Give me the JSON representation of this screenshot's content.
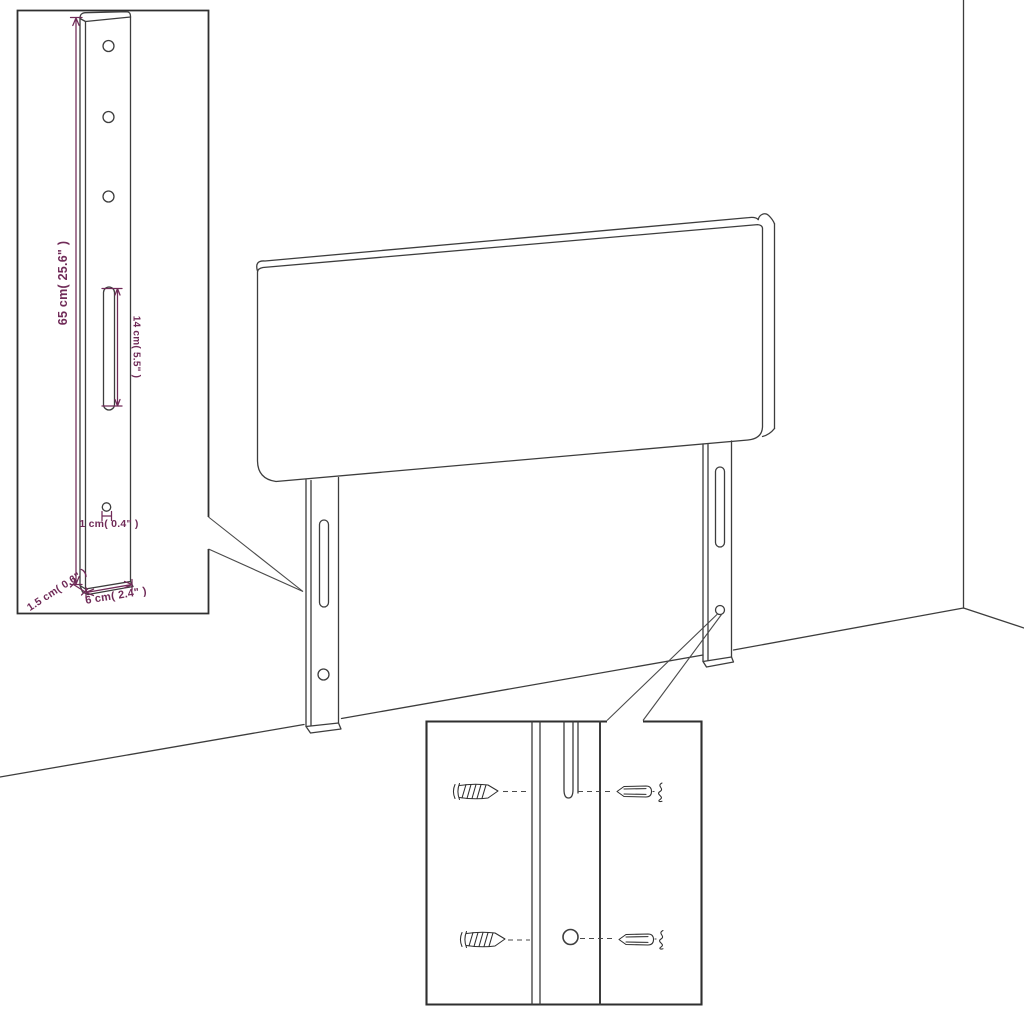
{
  "figure": {
    "kind": "furniture-assembly-dimension-diagram",
    "subject": "headboard with two mounting legs shown against a wall corner, with a bracket dimension callout and a screw mounting callout",
    "background": "#ffffff"
  },
  "colors": {
    "line_ink": "#3d3d3d",
    "dimension_ink": "#702b58"
  },
  "callouts": {
    "bracket_detail": {
      "labels": {
        "height": "65 cm( 25.6\" )",
        "slot_length": "14 cm( 5.5\" )",
        "hole": "1 cm( 0.4\" )",
        "thickness": "1.5 cm( 0.6\" )",
        "width": "6 cm( 2.4\" )"
      }
    },
    "screw_detail": {
      "icons": [
        "screw-icon",
        "wall-plug-icon",
        "anchor-squiggle-icon",
        "slot-hole",
        "round-hole"
      ]
    }
  }
}
